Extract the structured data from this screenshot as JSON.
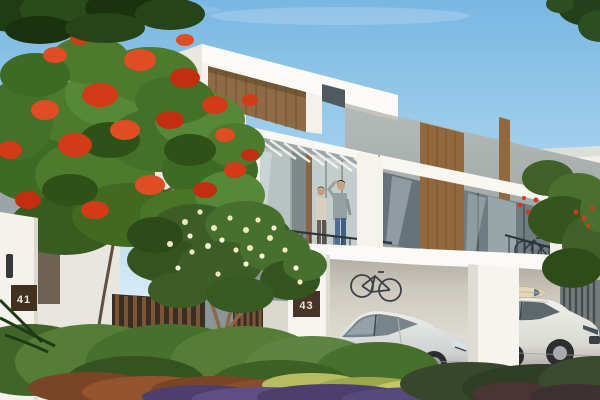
{
  "scene": {
    "type": "architectural-render",
    "title": "Modern two-storey white villas with carport, gardens, flame tree and residents on the balcony",
    "time_of_day": "day",
    "unit_plaques": {
      "left": "41",
      "right": "43"
    },
    "elements": [
      "sky",
      "overhanging-branches",
      "flame-tree",
      "frangipani-tree",
      "main-villa",
      "wood-cladding",
      "pergola",
      "balcony-people",
      "balcony-railing",
      "carport",
      "silver-sedan",
      "white-suv",
      "wall-bicycle",
      "floor-bicycle",
      "balcony-bicycle",
      "surfboard",
      "unit-41-pillar",
      "unit-43-pillar",
      "wood-slat-fence",
      "garden-hedges",
      "flower-beds",
      "driveway",
      "neighbour-villa-left",
      "neighbour-villa-right"
    ],
    "palette": {
      "sky_top": "#7cb9e3",
      "sky_horizon": "#ecf6fb",
      "villa_white": "#f9f7f2",
      "concrete_grey": "#a9afad",
      "wood_accent": "#92683e",
      "flame_red": "#d23a18",
      "foliage_green": "#4e7a2e",
      "hedge_green": "#567d36",
      "plaque_brown": "#47341f",
      "glass_grey": "#6e7d82",
      "jeans_blue": "#4d6d94"
    }
  }
}
